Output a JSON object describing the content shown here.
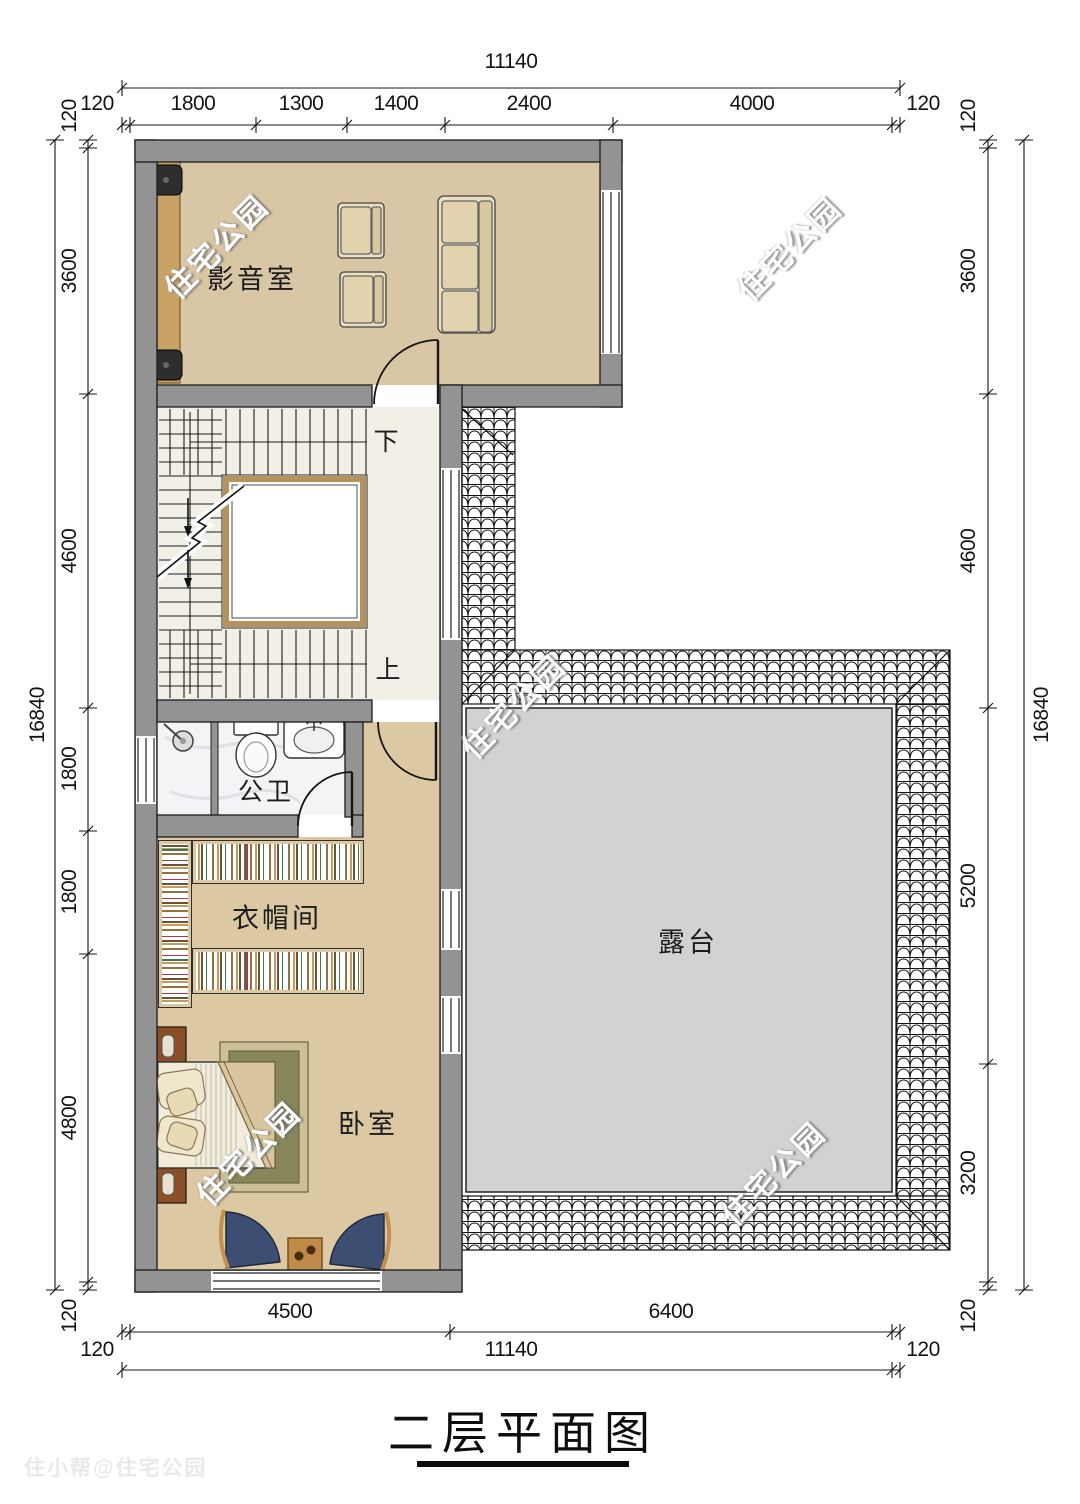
{
  "title": {
    "text": "二层平面图"
  },
  "watermark": {
    "text": "住宅公园",
    "credit": "住小帮@住宅公园"
  },
  "rooms": {
    "media": "影音室",
    "bath": "公卫",
    "cloak": "衣帽间",
    "bed": "卧室",
    "terrace": "露台"
  },
  "stairs": {
    "down": "下",
    "up": "上"
  },
  "dims": {
    "top_total": "11140",
    "top": [
      "120",
      "1800",
      "1300",
      "1400",
      "2400",
      "4000",
      "120"
    ],
    "bottom_inner": [
      "4500",
      "6400"
    ],
    "bottom_outer": [
      "120",
      "11140",
      "120"
    ],
    "left_total": "16840",
    "left": [
      "120",
      "3600",
      "4600",
      "1800",
      "1800",
      "4800",
      "120"
    ],
    "right_total": "16840",
    "right": [
      "120",
      "3600",
      "4600",
      "5200",
      "3200",
      "120"
    ]
  },
  "colors": {
    "wall": "#939393",
    "floor_tan": "#dcc9a4",
    "floor_media": "#d9c6a4",
    "stair_floor": "#f2efe7",
    "terrace": "#d2d2d2",
    "screen_wood": "#c9a265",
    "carpet": "#87875a",
    "chair_blue": "#3d4e72"
  }
}
